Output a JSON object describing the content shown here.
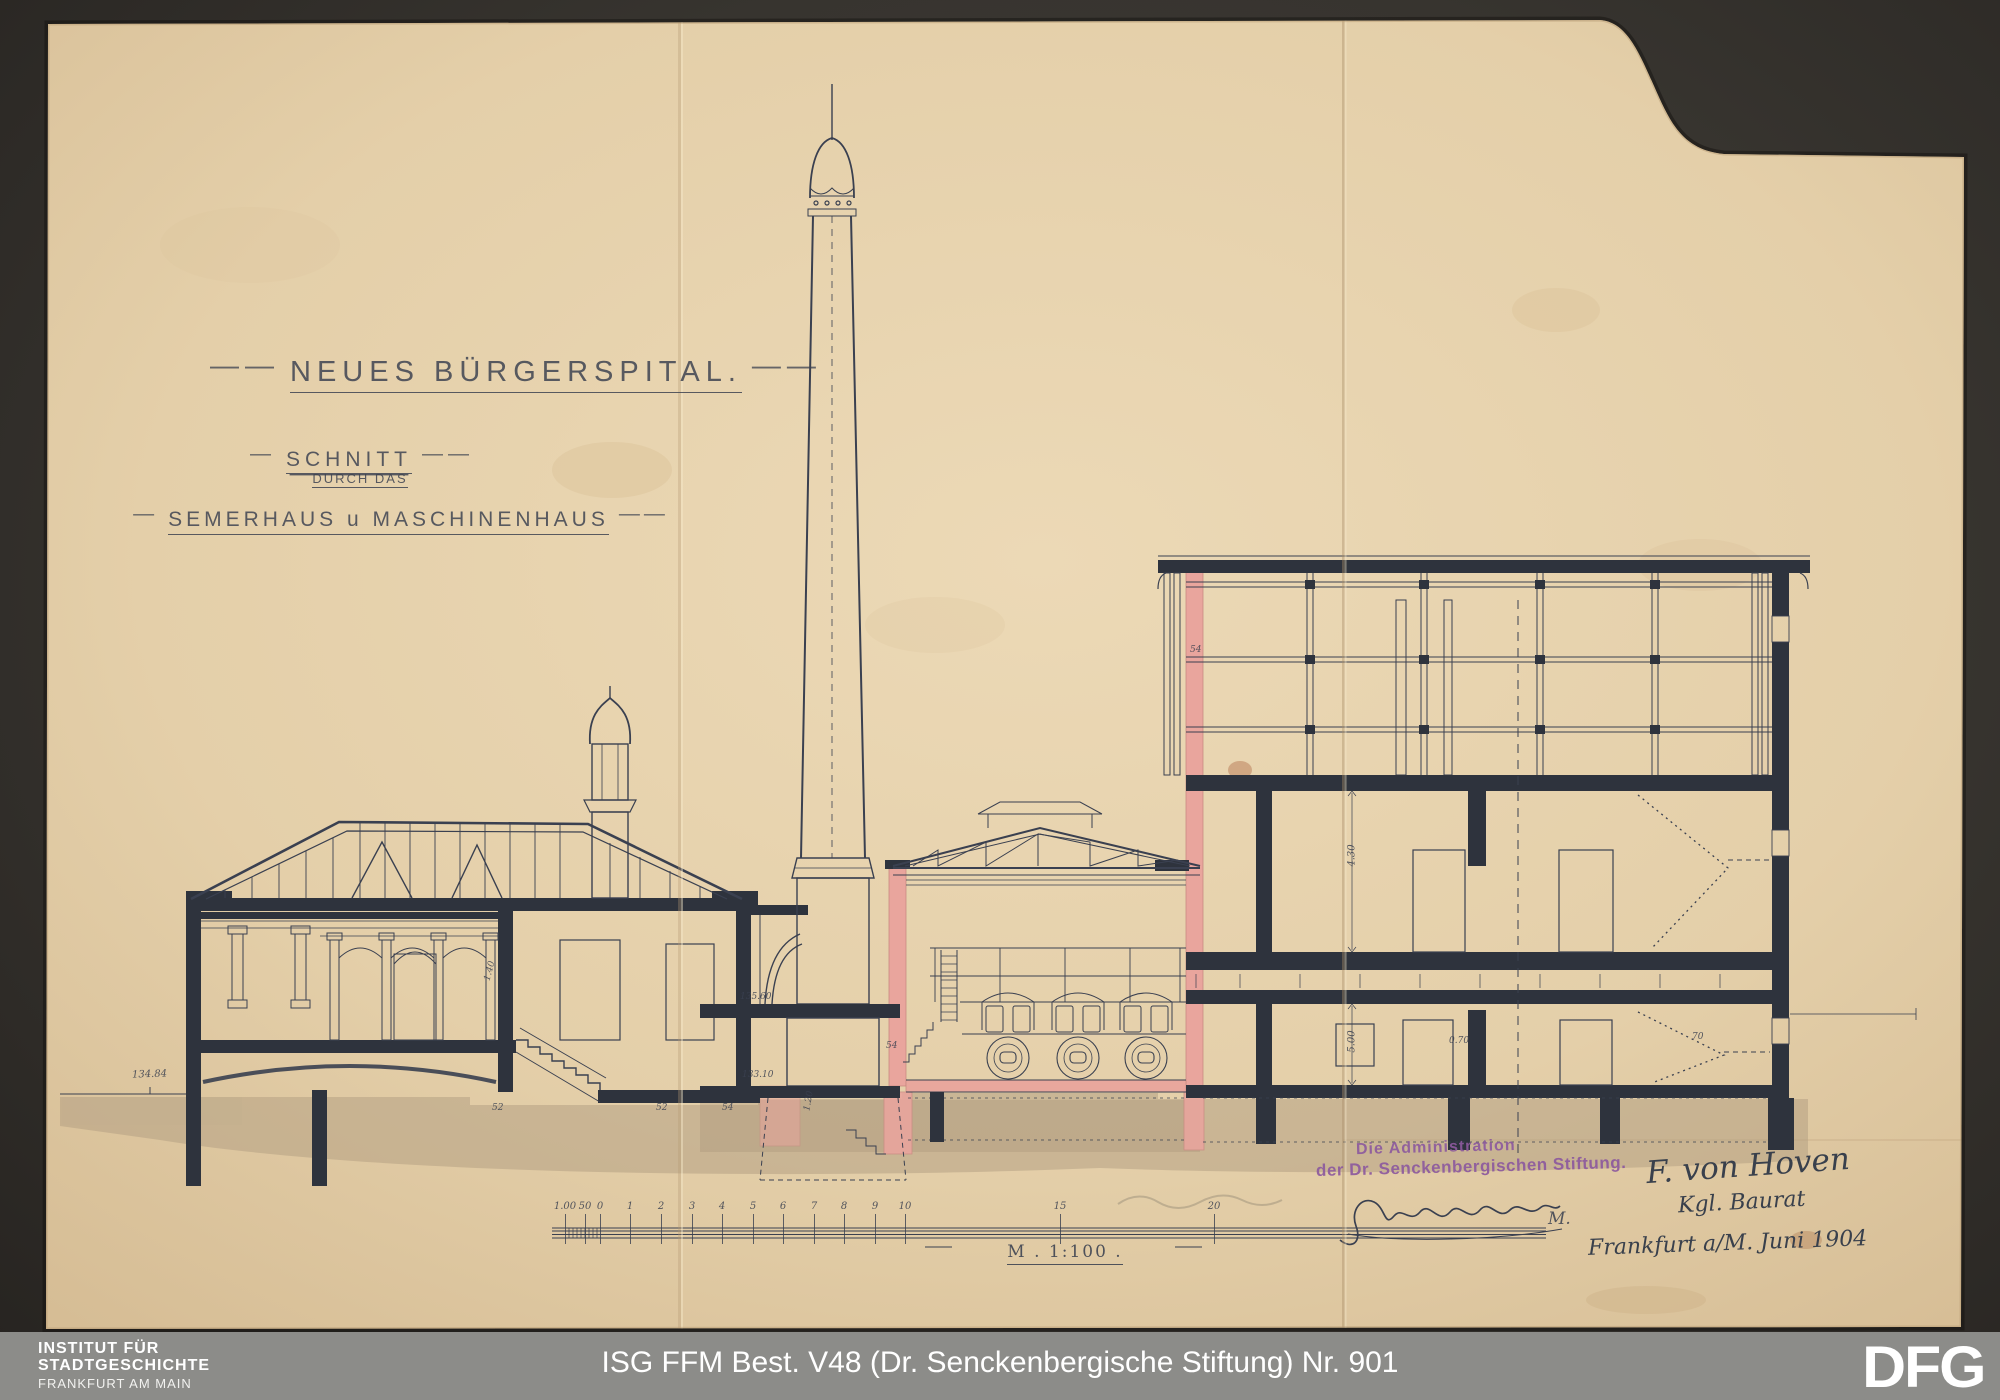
{
  "colors": {
    "background": "#37342f",
    "footer_bar": "#8c8c89",
    "paper": "#e6d1ad",
    "ink": "#3a4050",
    "section_pink": "#e9a59d",
    "stamp_purple": "#8d5a9e",
    "footer_text": "#ffffff"
  },
  "title_block": {
    "title": "NEUES BÜRGERSPITAL.",
    "subtitle1": "SCHNITT",
    "subtitle2": "DURCH DAS",
    "subtitle3": "SEMERHAUS u MASCHINENHAUS"
  },
  "scale_bar": {
    "label": "M . 1:100 .",
    "ticks": [
      {
        "label": "1.00",
        "x": 565
      },
      {
        "label": "50",
        "x": 585
      },
      {
        "label": "0",
        "x": 600
      },
      {
        "label": "1",
        "x": 630
      },
      {
        "label": "2",
        "x": 661
      },
      {
        "label": "3",
        "x": 692
      },
      {
        "label": "4",
        "x": 722
      },
      {
        "label": "5",
        "x": 753
      },
      {
        "label": "6",
        "x": 783
      },
      {
        "label": "7",
        "x": 814
      },
      {
        "label": "8",
        "x": 844
      },
      {
        "label": "9",
        "x": 875
      },
      {
        "label": "10",
        "x": 905
      },
      {
        "label": "15",
        "x": 1060
      },
      {
        "label": "20",
        "x": 1214
      }
    ]
  },
  "stamp": {
    "line1": "Die Administration",
    "line2": "der Dr. Senckenbergischen Stiftung."
  },
  "signature": {
    "name": "F. von Hoven",
    "title": "Kgl. Baurat",
    "date": "Frankfurt a/M. Juni 1904"
  },
  "annotations": [
    {
      "text": "134.84",
      "x": 132,
      "y": 1069,
      "size": 10,
      "rot": -2
    },
    {
      "text": "135.60",
      "x": 740,
      "y": 992,
      "size": 9,
      "rot": 0
    },
    {
      "text": "133.10",
      "x": 742,
      "y": 1070,
      "size": 9,
      "rot": 0
    },
    {
      "text": "1.40",
      "x": 480,
      "y": 966,
      "size": 9,
      "rot": -75
    },
    {
      "text": "52",
      "x": 492,
      "y": 1103,
      "size": 9,
      "rot": 0
    },
    {
      "text": "52",
      "x": 656,
      "y": 1103,
      "size": 9,
      "rot": 0
    },
    {
      "text": "54",
      "x": 722,
      "y": 1103,
      "size": 9,
      "rot": 0
    },
    {
      "text": "54",
      "x": 886,
      "y": 1041,
      "size": 9,
      "rot": 0
    },
    {
      "text": "54",
      "x": 1190,
      "y": 645,
      "size": 9,
      "rot": 0
    },
    {
      "text": "4.30",
      "x": 1341,
      "y": 850,
      "size": 10,
      "rot": -90
    },
    {
      "text": "5.00",
      "x": 1341,
      "y": 1036,
      "size": 10,
      "rot": -90
    },
    {
      "text": "0.70",
      "x": 1449,
      "y": 1036,
      "size": 9,
      "rot": 0
    },
    {
      "text": "70",
      "x": 1692,
      "y": 1032,
      "size": 9,
      "rot": 0
    },
    {
      "text": "1.20",
      "x": 799,
      "y": 1096,
      "size": 9,
      "rot": -80
    },
    {
      "text": "M.",
      "x": 1548,
      "y": 1209,
      "size": 17,
      "rot": 0
    }
  ],
  "footer": {
    "institute_line1": "INSTITUT FÜR",
    "institute_line2": "STADTGESCHICHTE",
    "institute_line3": "FRANKFURT AM MAIN",
    "caption": "ISG FFM Best. V48 (Dr. Senckenbergische Stiftung) Nr. 901",
    "dfg_logo": "DFG"
  }
}
